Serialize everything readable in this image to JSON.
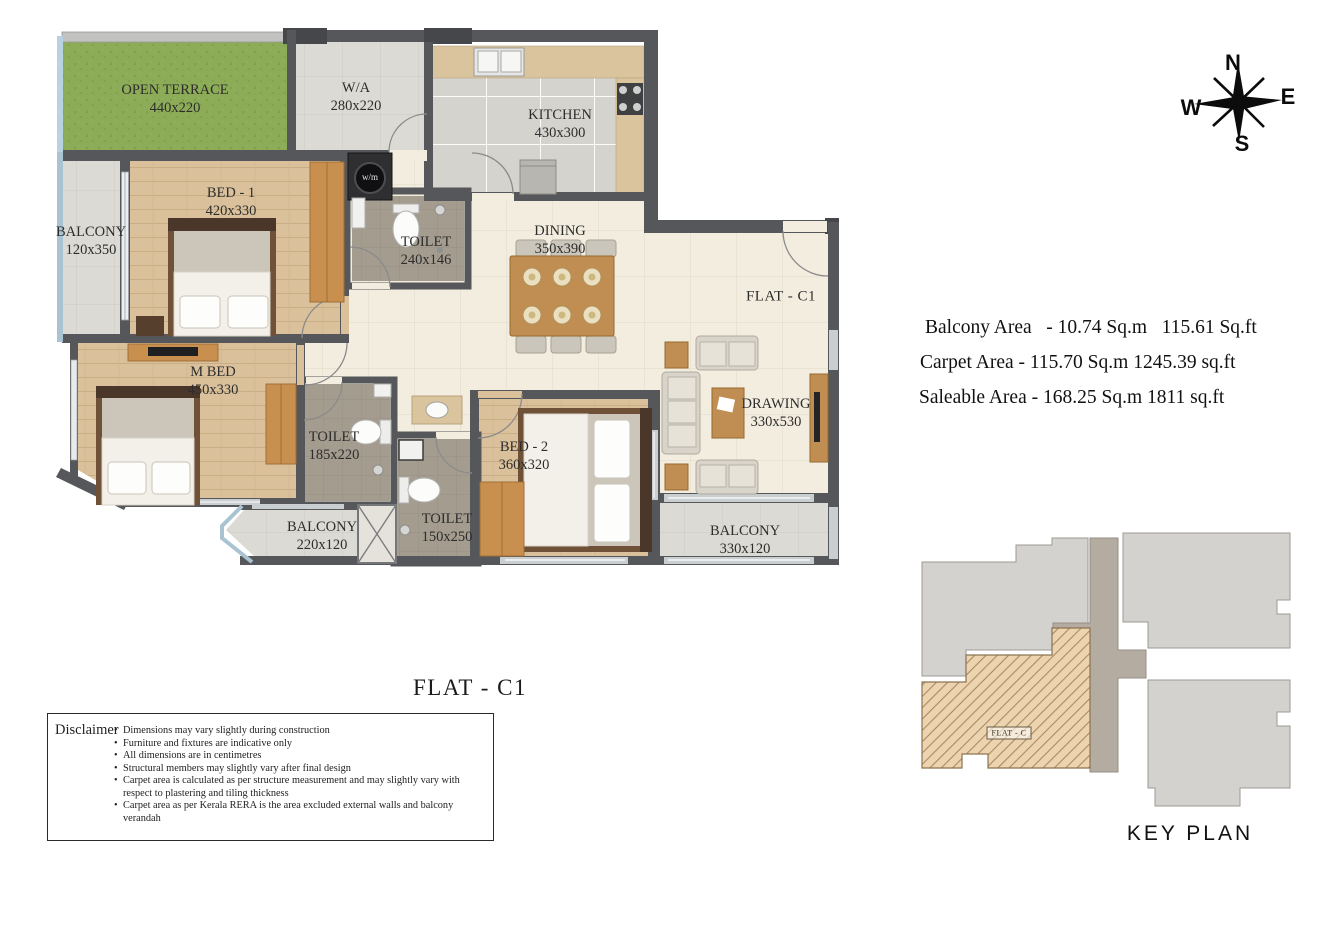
{
  "plan": {
    "title": "FLAT - C1",
    "flat_label": "FLAT - C1",
    "appliance_label": "w/m",
    "rooms": [
      {
        "id": "open-terrace",
        "name": "OPEN TERRACE",
        "dims": "440x220"
      },
      {
        "id": "washing-area",
        "name": "W/A",
        "dims": "280x220"
      },
      {
        "id": "kitchen",
        "name": "KITCHEN",
        "dims": "430x300"
      },
      {
        "id": "balcony-left",
        "name": "BALCONY",
        "dims": "120x350"
      },
      {
        "id": "bed-1",
        "name": "BED - 1",
        "dims": "420x330"
      },
      {
        "id": "toilet-1",
        "name": "TOILET",
        "dims": "240x146"
      },
      {
        "id": "dining",
        "name": "DINING",
        "dims": "350x390"
      },
      {
        "id": "master-bed",
        "name": "M BED",
        "dims": "450x330"
      },
      {
        "id": "toilet-2",
        "name": "TOILET",
        "dims": "185x220"
      },
      {
        "id": "bed-2",
        "name": "BED - 2",
        "dims": "360x320"
      },
      {
        "id": "toilet-3",
        "name": "TOILET",
        "dims": "150x250"
      },
      {
        "id": "drawing",
        "name": "DRAWING",
        "dims": "330x530"
      },
      {
        "id": "balcony-bottom-left",
        "name": "BALCONY",
        "dims": "220x120"
      },
      {
        "id": "balcony-bottom-right",
        "name": "BALCONY",
        "dims": "330x120"
      }
    ]
  },
  "areas": {
    "line1": "Balcony Area   - 10.74 Sq.m   115.61 Sq.ft",
    "line2": "Carpet Area - 115.70 Sq.m 1245.39 sq.ft",
    "line3": "Saleable Area - 168.25 Sq.m 1811 sq.ft"
  },
  "compass": {
    "n": "N",
    "e": "E",
    "s": "S",
    "w": "W"
  },
  "disclaimer": {
    "title": "Disclaimer",
    "items": [
      "Dimensions may vary slightly during construction",
      "Furniture and fixtures are indicative only",
      "All dimensions are in centimetres",
      "Structural members may slightly vary after final design",
      "Carpet area is calculated as per structure measurement and may slightly vary with respect to plastering and tiling thickness",
      "Carpet area as per Kerala RERA is the area excluded external walls and balcony verandah"
    ]
  },
  "key_plan": {
    "title": "KEY PLAN",
    "flat_label": "FLAT - C"
  },
  "colors": {
    "wall": "#56575a",
    "wood_floor": "#dac19c",
    "terrace_green": "#8dac57",
    "cream_floor": "#f2eddf",
    "toilet_floor": "#a49c8f",
    "counter": "#d9c49e",
    "wardrobe_wood": "#c98f4e",
    "keyplan_highlight": "#ecd4b0"
  }
}
